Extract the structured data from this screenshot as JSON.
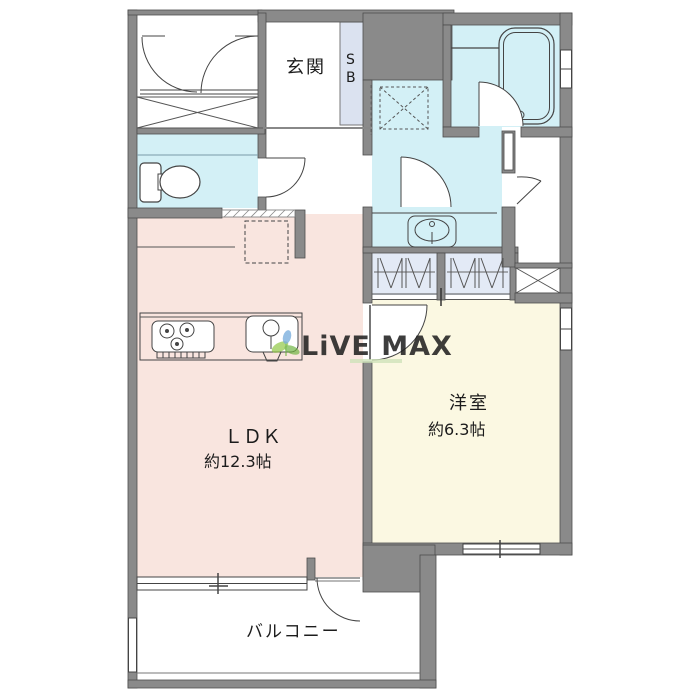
{
  "rooms": {
    "entrance": {
      "label": "玄関"
    },
    "shoe_box": {
      "line1": "S",
      "line2": "B"
    },
    "ldk": {
      "label": "ＬＤＫ",
      "size": "約12.3帖"
    },
    "western_room": {
      "label": "洋室",
      "size": "約6.3帖"
    },
    "balcony": {
      "label": "バルコニー"
    }
  },
  "watermark": {
    "text": "LiVE MAX"
  },
  "colors": {
    "wall": "#8a8a8a",
    "wall_edge": "#4d4d4d",
    "wet_area": "#d3f0f6",
    "ldk": "#f9e5df",
    "western_room": "#fbf8e2",
    "closet": "#e3eaf6",
    "shoe_box": "#dbe2f0",
    "watermark_text": "#b4bcd8",
    "watermark_leaf": "#8cc63f",
    "watermark_petal": "#5b9bd5"
  }
}
